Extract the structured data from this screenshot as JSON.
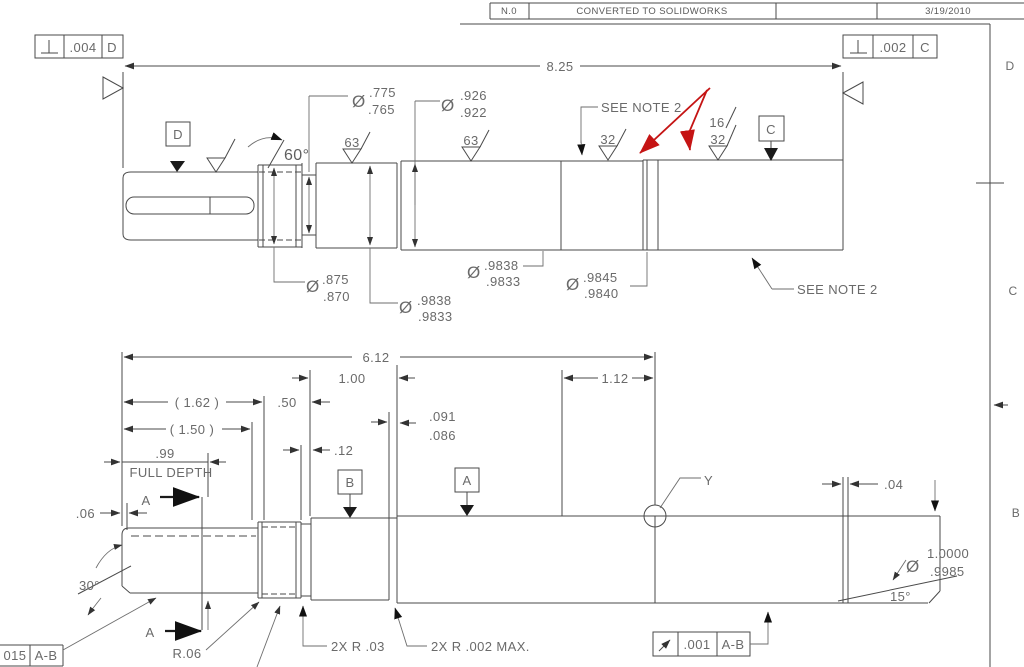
{
  "revision_strip": {
    "rev": "N.0",
    "description": "CONVERTED TO SOLIDWORKS",
    "date": "3/19/2010"
  },
  "zones": {
    "d": "D",
    "c": "C",
    "b": "B"
  },
  "feature_controls": {
    "top_left": {
      "symbol": "perpendicularity",
      "tolerance": ".004",
      "datum": "D"
    },
    "top_right": {
      "symbol": "perpendicularity",
      "tolerance": ".002",
      "datum": "C"
    },
    "runout": {
      "symbol": "circular-runout",
      "tolerance": ".001",
      "datum": "A-B"
    },
    "bottom_left": {
      "tolerance": "015",
      "datum": "A-B"
    }
  },
  "top_view": {
    "overall_length": "8.25",
    "thread_angle": "60°",
    "datum_d": "D",
    "datum_c": "C",
    "see_note_upper": "SEE NOTE 2",
    "see_note_lower": "SEE NOTE 2",
    "finish": {
      "f63a": "63",
      "f63b": "63",
      "f32a": "32",
      "f16": "16",
      "f32b": "32"
    },
    "dia_765": {
      "sym": "Ø",
      "upper": ".775",
      "lower": ".765"
    },
    "dia_926": {
      "sym": "Ø",
      "upper": ".926",
      "lower": ".922"
    },
    "dia_875": {
      "sym": "Ø",
      "upper": ".875",
      "lower": ".870"
    },
    "dia_9838_left": {
      "sym": "Ø",
      "upper": ".9838",
      "lower": ".9833"
    },
    "dia_9838_right": {
      "sym": "Ø",
      "upper": ".9838",
      "lower": ".9833"
    },
    "dia_9845": {
      "sym": "Ø",
      "upper": ".9845",
      "lower": ".9840"
    }
  },
  "bottom_view": {
    "dim_612": "6.12",
    "dim_100": "1.00",
    "dim_112": "1.12",
    "dim_162": "( 1.62 )",
    "dim_150": "( 1.50 )",
    "dim_99": ".99",
    "full_depth": "FULL DEPTH",
    "dim_50": ".50",
    "dim_12": ".12",
    "groove_upper": ".091",
    "groove_lower": ".086",
    "dim_06": ".06",
    "dim_04": ".04",
    "angle_30": "30°",
    "angle_15": "15°",
    "dia_main": {
      "sym": "Ø",
      "upper": "1.0000",
      "lower": ".9985"
    },
    "label_y": "Y",
    "datum_a": "A",
    "datum_b": "B",
    "section_a_top": "A",
    "section_a_bottom": "A",
    "radius": "R.06",
    "note_r03": "2X R .03",
    "note_r002": "2X R .002 MAX."
  }
}
